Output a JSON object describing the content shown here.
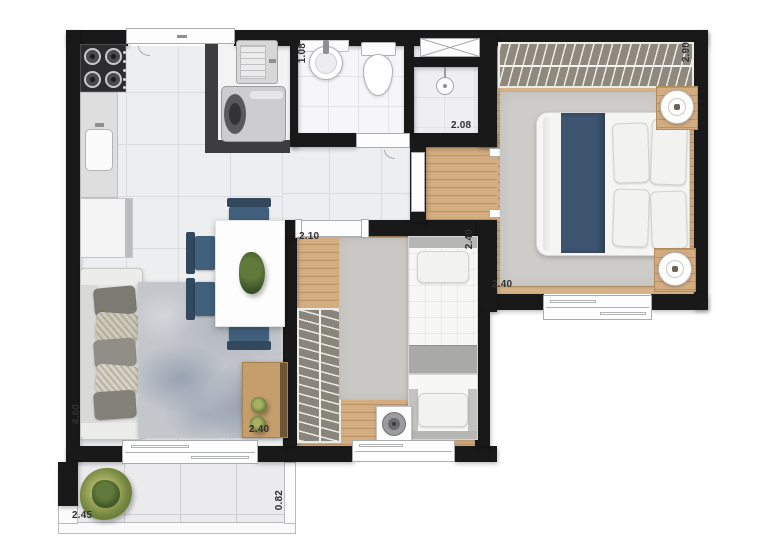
{
  "floor_plan": {
    "dimension_labels": {
      "bathroom_width": "1.08",
      "bathroom_length": "2.08",
      "main_bedroom_depth": "2.90",
      "main_bedroom_width": "2.40",
      "second_bedroom_entry": "2.10",
      "second_bedroom_depth": "2.40",
      "living_room_length": "4.60",
      "living_room_width": "2.40",
      "balcony_length": "2.45",
      "balcony_depth": "0.82"
    },
    "colors": {
      "wall": "#191919",
      "wood_floor": "#d3ad80",
      "tile_floor": "#eceef0",
      "accent_blue": "#3e5570",
      "wardrobe_fill": "#8e887d",
      "plant_green": "#73863f"
    }
  }
}
